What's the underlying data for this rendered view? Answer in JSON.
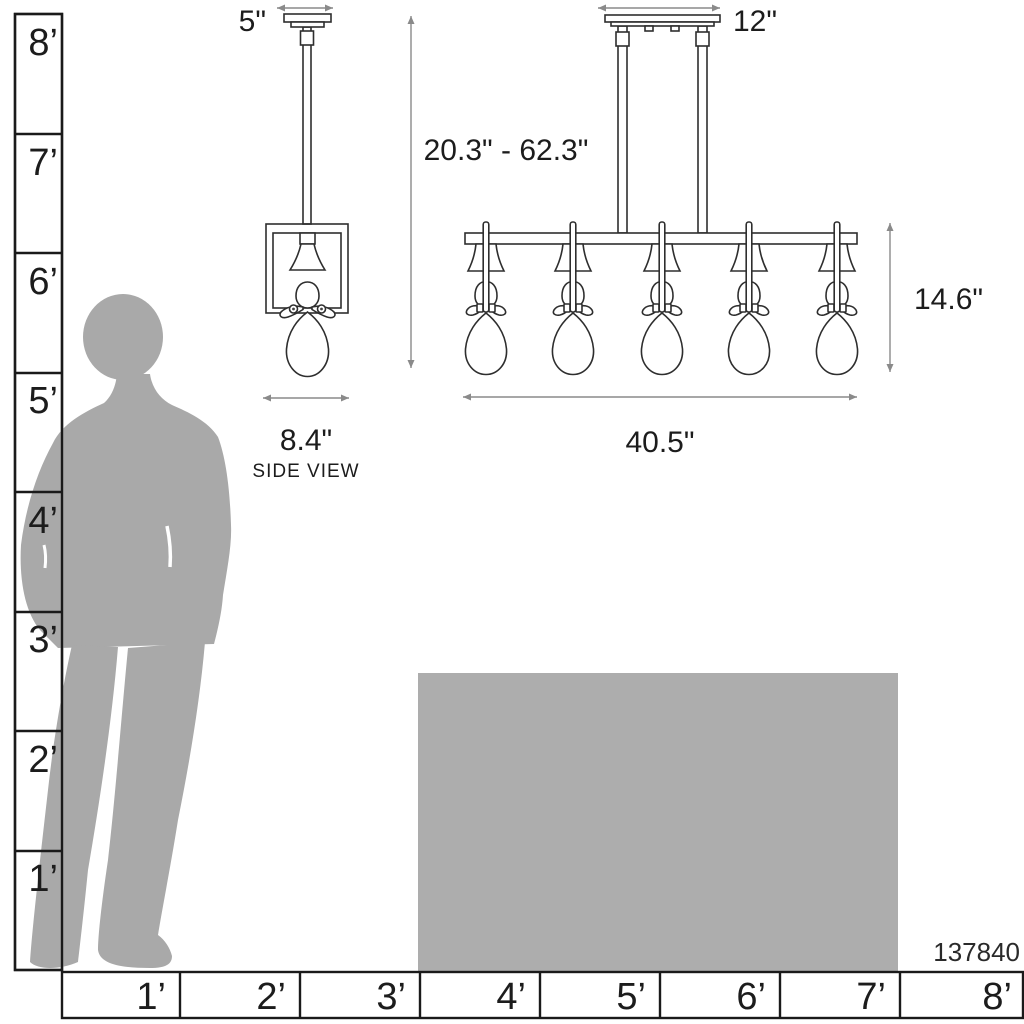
{
  "product_code": "137840",
  "side_view": {
    "canopy_width_label": "5\"",
    "fixture_width_label": "8.4\"",
    "caption": "SIDE VIEW"
  },
  "front_view": {
    "canopy_width_label": "12\"",
    "height_range_label": "20.3\" - 62.3\"",
    "body_height_label": "14.6\"",
    "fixture_width_label": "40.5\"",
    "num_lights": 5
  },
  "height_ruler": {
    "unit": "feet",
    "labels": [
      "8’",
      "7’",
      "6’",
      "5’",
      "4’",
      "3’",
      "2’",
      "1’"
    ]
  },
  "width_ruler": {
    "unit": "feet",
    "labels": [
      "1’",
      "2’",
      "3’",
      "4’",
      "5’",
      "6’",
      "7’",
      "8’"
    ]
  },
  "colors": {
    "line_art": "#2e2e2e",
    "ruler_line": "#1a1a1a",
    "arrow": "#8a8a8a",
    "text": "#1c1c1c",
    "silhouette": "#a9a9a9",
    "table": "#adadad",
    "background": "#ffffff"
  }
}
